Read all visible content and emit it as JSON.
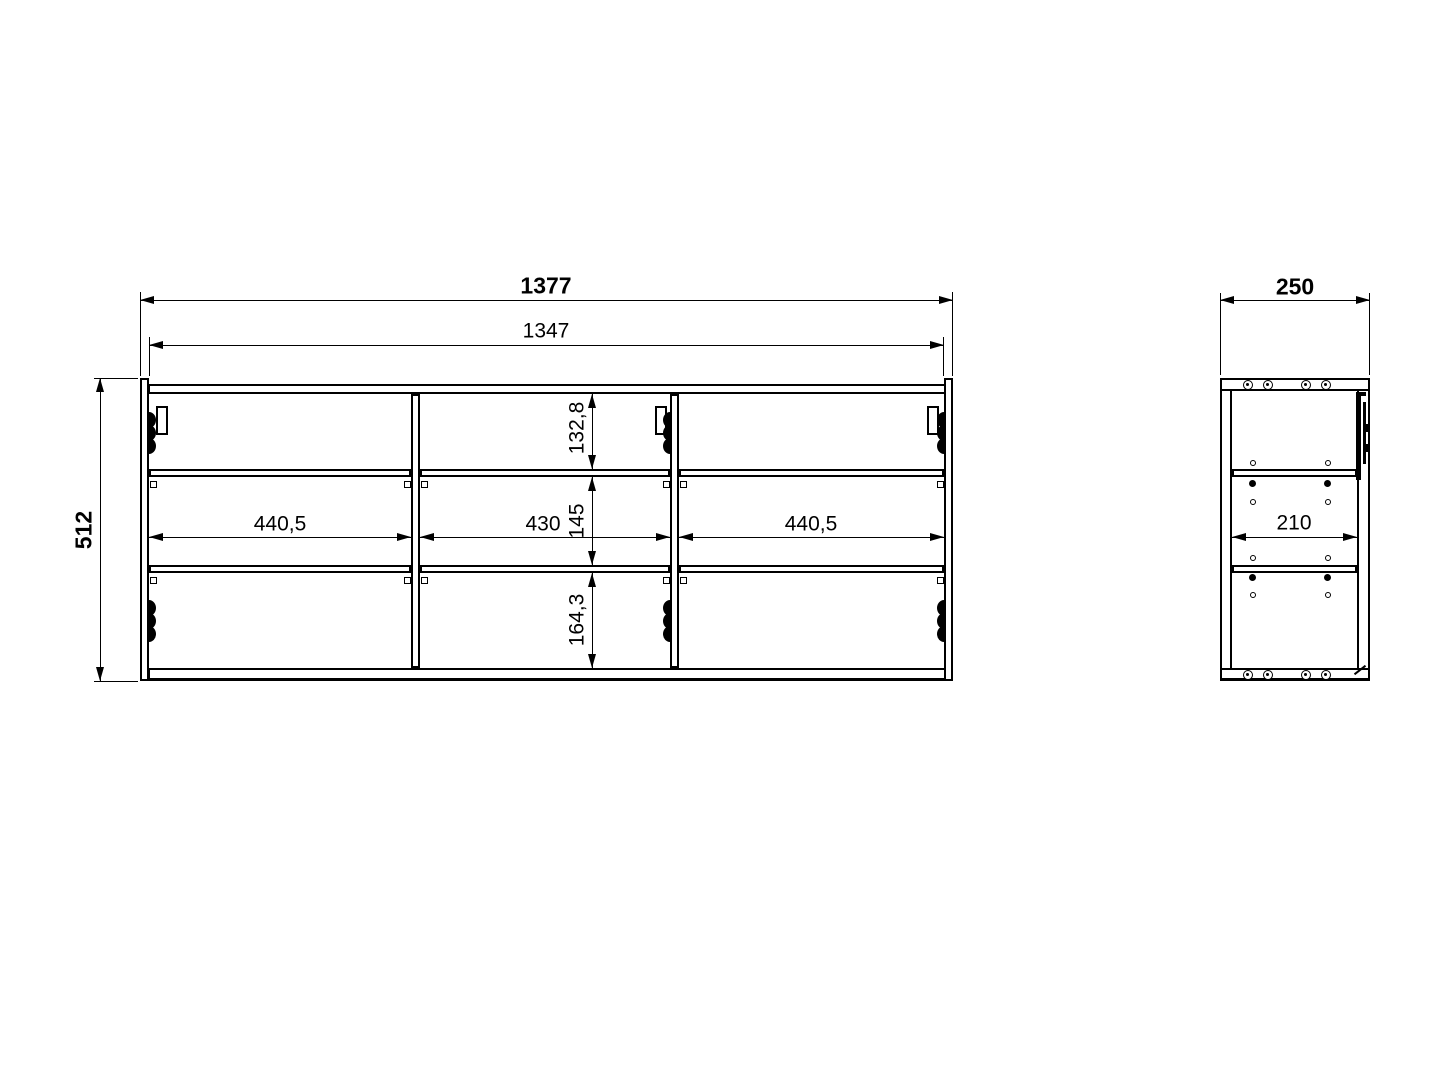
{
  "drawing": {
    "front_view": {
      "overall_width": "1377",
      "inner_width": "1347",
      "overall_height": "512",
      "compartment_widths": [
        "440,5",
        "430",
        "440,5"
      ],
      "shelf_spacings": [
        "132,8",
        "145",
        "164,3"
      ]
    },
    "side_view": {
      "overall_depth": "250",
      "inner_depth": "210"
    }
  }
}
